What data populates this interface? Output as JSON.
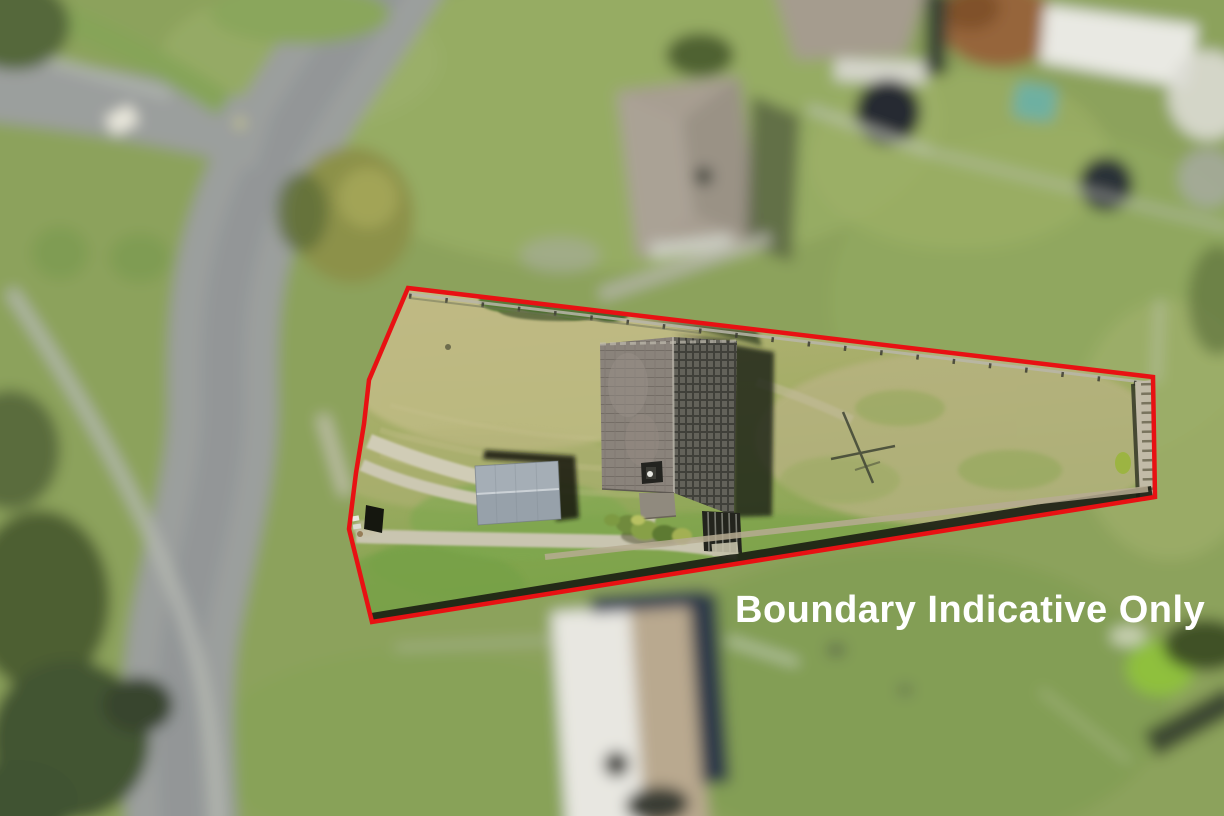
{
  "overlay": {
    "disclaimer_text": "Boundary Indicative Only"
  },
  "colors": {
    "boundary_red": "#e81113",
    "disclaimer_white": "#ffffff"
  },
  "boundary": {
    "points": "408,288 1153,377 1155,497 372,622 349,529 356,473 364,424 369,380",
    "stroke_width": 4.5
  }
}
